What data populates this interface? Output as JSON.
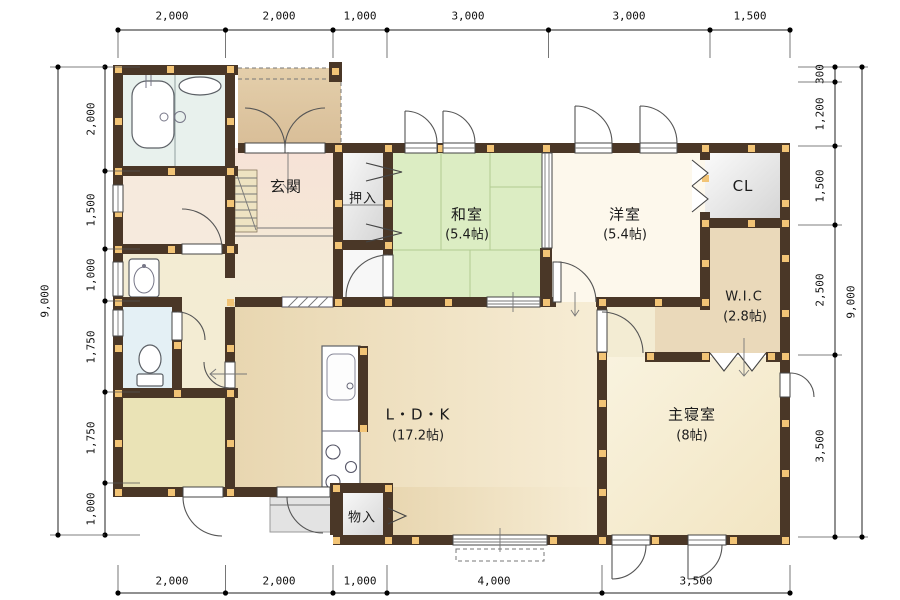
{
  "rooms": {
    "genkan": {
      "label": "玄関"
    },
    "oshiire": {
      "label": "押入"
    },
    "washitsu": {
      "label": "和室",
      "size": "(5.4帖)"
    },
    "youshitsu": {
      "label": "洋室",
      "size": "(5.4帖)"
    },
    "cl": {
      "label": "CL"
    },
    "wic": {
      "label": "W.I.C",
      "size": "(2.8帖)"
    },
    "ldk": {
      "label": "L・D・K",
      "size": "(17.2帖)"
    },
    "shinshitsu": {
      "label": "主寝室",
      "size": "(8帖)"
    },
    "monoire": {
      "label": "物入"
    }
  },
  "dimensions": {
    "top": [
      "2,000",
      "2,000",
      "1,000",
      "3,000",
      "3,000",
      "1,500"
    ],
    "bottom": [
      "2,000",
      "2,000",
      "1,000",
      "4,000",
      "3,500"
    ],
    "left": [
      "2,000",
      "1,500",
      "1,000",
      "1,750",
      "1,750",
      "1,000"
    ],
    "left_total": "9,000",
    "right": [
      "300",
      "1,200",
      "1,500",
      "2,500",
      "3,500"
    ],
    "right_total": "9,000"
  },
  "colors": {
    "wall": "#4a3727",
    "pillar": "#f2c476",
    "tatami": "#dcedc3",
    "ldk_floor": "#ecdcba",
    "bedroom_floor": "#f8f1da",
    "bath_floor": "#e8f1ed",
    "toilet_floor": "#e4f0f5"
  }
}
